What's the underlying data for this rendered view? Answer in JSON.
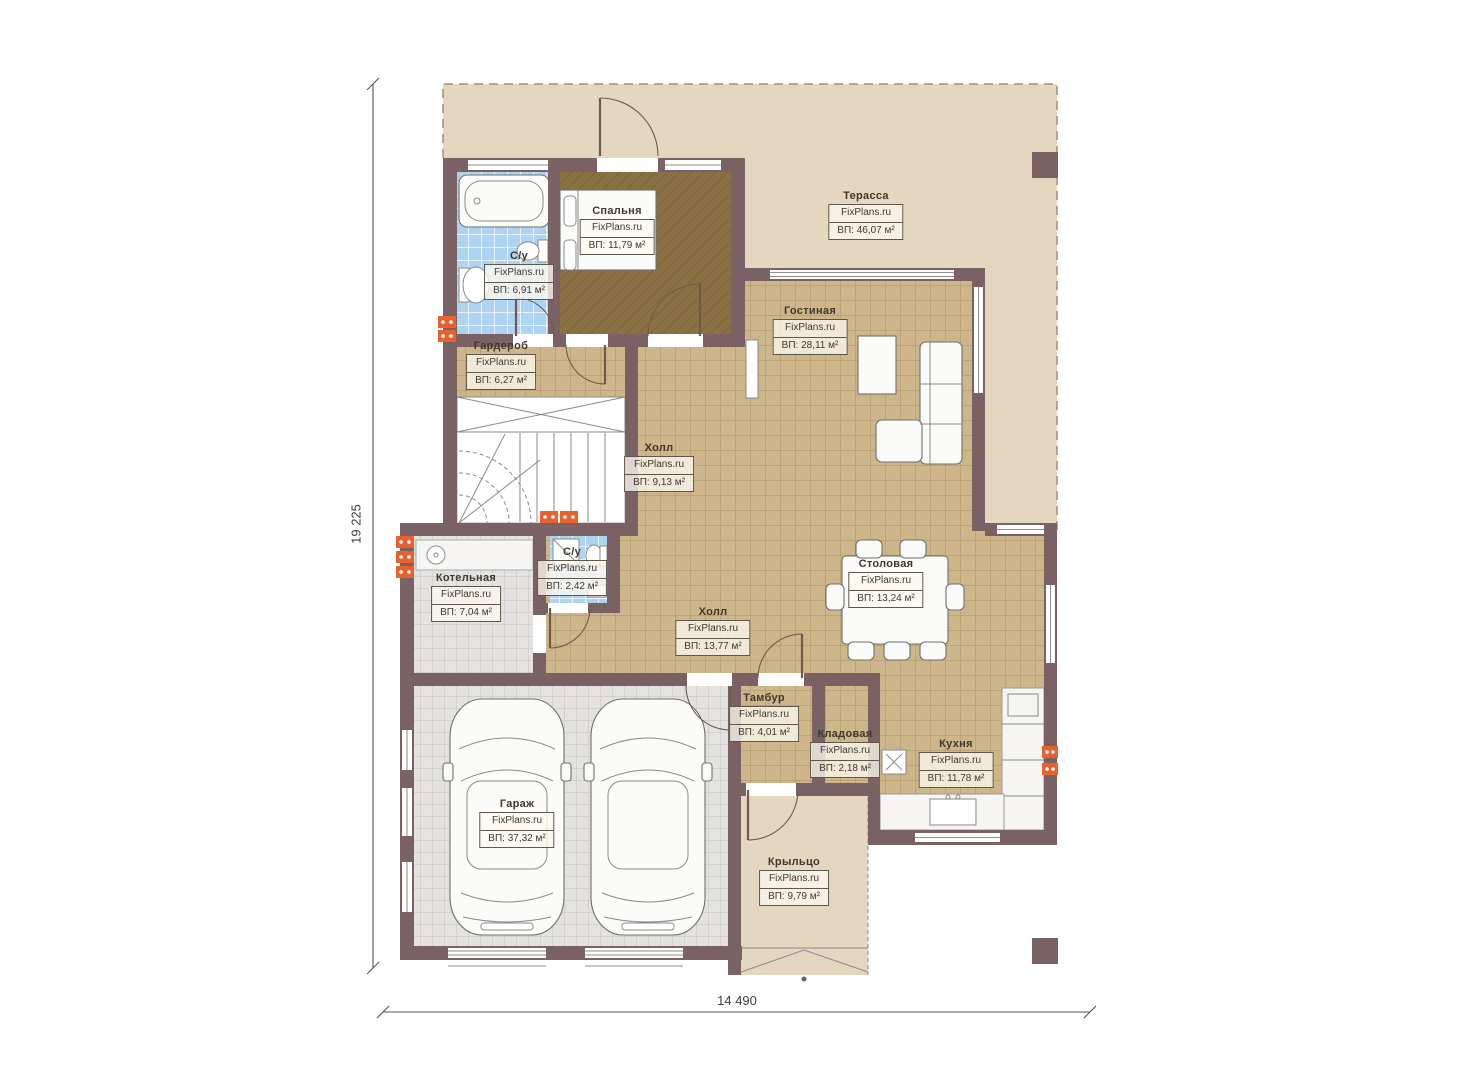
{
  "plan": {
    "dimensions": {
      "height_label": "19 225",
      "width_label": "14 490"
    },
    "rooms": [
      {
        "name": "Спальня",
        "watermark": "FixPlans.ru",
        "area": "ВП: 11,79 м²"
      },
      {
        "name": "С/у",
        "watermark": "FixPlans.ru",
        "area": "ВП: 6,91 м²"
      },
      {
        "name": "Терасса",
        "watermark": "FixPlans.ru",
        "area": "ВП: 46,07 м²"
      },
      {
        "name": "Гостиная",
        "watermark": "FixPlans.ru",
        "area": "ВП: 28,11 м²"
      },
      {
        "name": "Гардероб",
        "watermark": "FixPlans.ru",
        "area": "ВП: 6,27 м²"
      },
      {
        "name": "Холл",
        "watermark": "FixPlans.ru",
        "area": "ВП: 9,13 м²"
      },
      {
        "name": "С/у",
        "watermark": "FixPlans.ru",
        "area": "ВП: 2,42 м²"
      },
      {
        "name": "Котельная",
        "watermark": "FixPlans.ru",
        "area": "ВП: 7,04 м²"
      },
      {
        "name": "Холл",
        "watermark": "FixPlans.ru",
        "area": "ВП: 13,77 м²"
      },
      {
        "name": "Столовая",
        "watermark": "FixPlans.ru",
        "area": "ВП: 13,24 м²"
      },
      {
        "name": "Тамбур",
        "watermark": "FixPlans.ru",
        "area": "ВП: 4,01 м²"
      },
      {
        "name": "Кладовая",
        "watermark": "FixPlans.ru",
        "area": "ВП: 2,18 м²"
      },
      {
        "name": "Кухня",
        "watermark": "FixPlans.ru",
        "area": "ВП: 11,78 м²"
      },
      {
        "name": "Гараж",
        "watermark": "FixPlans.ru",
        "area": "ВП: 37,32 м²"
      },
      {
        "name": "Крыльцо",
        "watermark": "FixPlans.ru",
        "area": "ВП: 9,79 м²"
      }
    ]
  },
  "colors": {
    "wall": "#7a6264",
    "terrace": "#e5d6c0",
    "tile_tan": "#cdb68a",
    "tile_tan_line": "#ac9263",
    "tile_gray": "#e4e3e1",
    "tile_gray_line": "#c2c0bd",
    "tile_blue": "#aed4f2",
    "tile_blue_line": "#ffffff",
    "wood": "#8a7143",
    "wood_line": "#7b6539",
    "marker": "#e8622d"
  }
}
